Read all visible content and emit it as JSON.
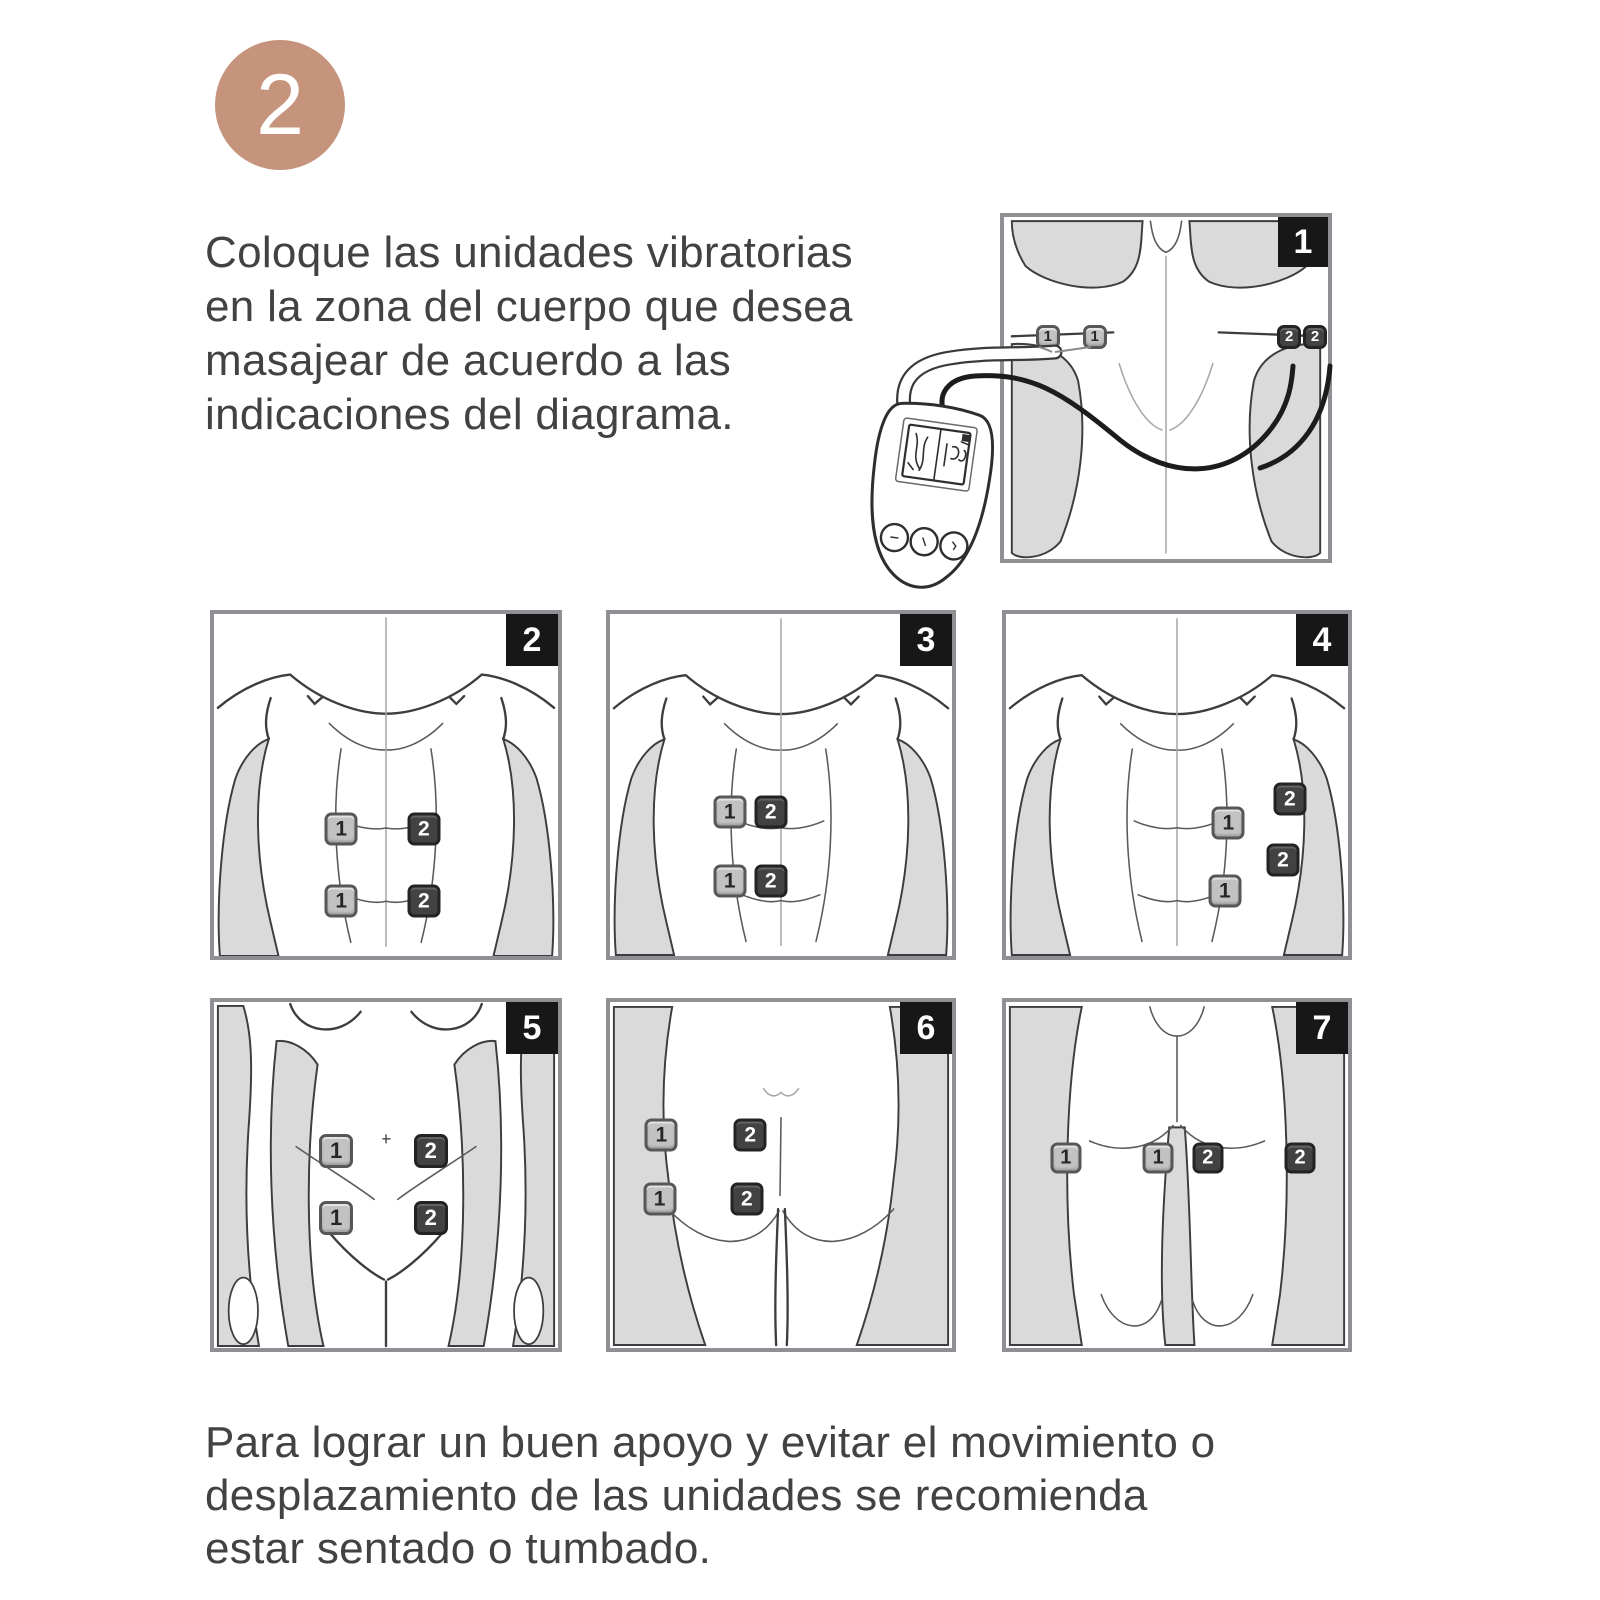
{
  "step": {
    "number": "2"
  },
  "intro": {
    "lines": [
      "Coloque las unidades vibratorias",
      "en la zona del cuerpo que desea",
      "masajear de acuerdo a las",
      "indicaciones del diagrama."
    ]
  },
  "footer": {
    "lines": [
      "Para lograr un buen apoyo y evitar el movimiento o",
      "desplazamiento de las unidades se recomienda",
      "estar sentado o tumbado."
    ]
  },
  "colors": {
    "step_circle": "#c6937c",
    "badge_bg": "#171717",
    "pad_light": "#c2c2c2",
    "pad_dark": "#424242",
    "body_shade": "#dadada",
    "outline": "#3d3d3d",
    "frame": "#8f9094",
    "wire_dark": "#1c1c1c",
    "wire_light": "#9a9a9a"
  },
  "icons": {
    "controller": "tens-remote-with-screen-and-3-buttons",
    "pad": "square-electrode-pad"
  },
  "diagrams": [
    {
      "badge": "1",
      "body_region": "upper-back-shoulders",
      "pad_size_px": 24,
      "pads": [
        {
          "label": "1",
          "variant": "light",
          "x": 13.5,
          "y": 35
        },
        {
          "label": "1",
          "variant": "light",
          "x": 28,
          "y": 35
        },
        {
          "label": "2",
          "variant": "dark",
          "x": 88,
          "y": 35
        },
        {
          "label": "2",
          "variant": "dark",
          "x": 96,
          "y": 35
        }
      ]
    },
    {
      "badge": "2",
      "body_region": "abdomen-front",
      "pad_size_px": 33,
      "pads": [
        {
          "label": "1",
          "variant": "light",
          "x": 37,
          "y": 63
        },
        {
          "label": "2",
          "variant": "dark",
          "x": 61,
          "y": 63
        },
        {
          "label": "1",
          "variant": "light",
          "x": 37,
          "y": 84
        },
        {
          "label": "2",
          "variant": "dark",
          "x": 61,
          "y": 84
        }
      ]
    },
    {
      "badge": "3",
      "body_region": "abdomen-front-left",
      "pad_size_px": 33,
      "pads": [
        {
          "label": "1",
          "variant": "light",
          "x": 35,
          "y": 58
        },
        {
          "label": "2",
          "variant": "dark",
          "x": 47,
          "y": 58
        },
        {
          "label": "1",
          "variant": "light",
          "x": 35,
          "y": 78
        },
        {
          "label": "2",
          "variant": "dark",
          "x": 47,
          "y": 78
        }
      ]
    },
    {
      "badge": "4",
      "body_region": "abdomen-front-right-oblique",
      "pad_size_px": 33,
      "pads": [
        {
          "label": "2",
          "variant": "dark",
          "x": 83,
          "y": 54
        },
        {
          "label": "1",
          "variant": "light",
          "x": 65,
          "y": 61
        },
        {
          "label": "2",
          "variant": "dark",
          "x": 81,
          "y": 72
        },
        {
          "label": "1",
          "variant": "light",
          "x": 64,
          "y": 81
        }
      ]
    },
    {
      "badge": "5",
      "body_region": "lower-abdomen-front",
      "pad_size_px": 34,
      "pads": [
        {
          "label": "1",
          "variant": "light",
          "x": 35.5,
          "y": 43
        },
        {
          "label": "2",
          "variant": "dark",
          "x": 63,
          "y": 43
        },
        {
          "label": "1",
          "variant": "light",
          "x": 35.5,
          "y": 62.5
        },
        {
          "label": "2",
          "variant": "dark",
          "x": 63,
          "y": 62.5
        }
      ]
    },
    {
      "badge": "6",
      "body_region": "hips-buttocks-rear",
      "pad_size_px": 33,
      "pads": [
        {
          "label": "1",
          "variant": "light",
          "x": 15,
          "y": 38.5
        },
        {
          "label": "2",
          "variant": "dark",
          "x": 41,
          "y": 38.5
        },
        {
          "label": "1",
          "variant": "light",
          "x": 14.5,
          "y": 57
        },
        {
          "label": "2",
          "variant": "dark",
          "x": 40,
          "y": 57
        }
      ]
    },
    {
      "badge": "7",
      "body_region": "thighs-rear",
      "pad_size_px": 31,
      "pads": [
        {
          "label": "1",
          "variant": "light",
          "x": 17.5,
          "y": 45
        },
        {
          "label": "1",
          "variant": "light",
          "x": 44.5,
          "y": 45
        },
        {
          "label": "2",
          "variant": "dark",
          "x": 59,
          "y": 45
        },
        {
          "label": "2",
          "variant": "dark",
          "x": 86,
          "y": 45
        }
      ]
    }
  ]
}
